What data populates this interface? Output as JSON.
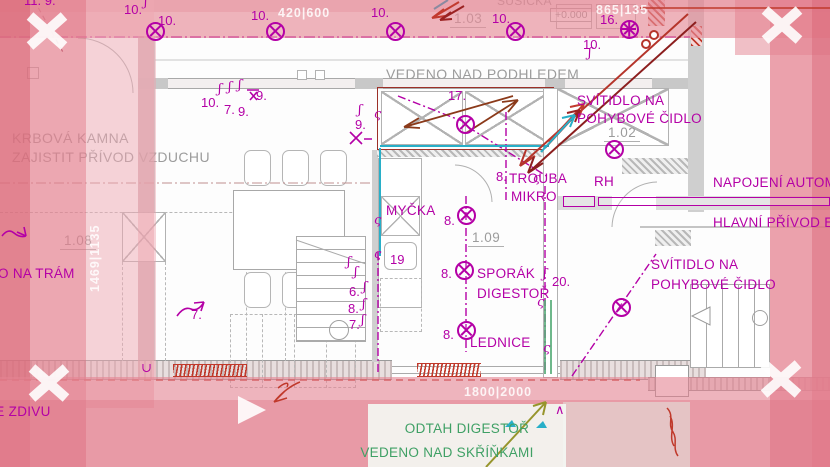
{
  "colors": {
    "magenta": "#b400a6",
    "gray_text": "#9c9c9c",
    "dark_red": "#9c3028",
    "red": "#c0392b",
    "cyan": "#28afc8",
    "green": "#3fa065",
    "olive": "#97952c",
    "pink_overlay": "#e48a9b"
  },
  "plan_texts": [
    {
      "t": "KRBOVÁ KAMNA",
      "x": 12,
      "y": 130,
      "c": "gtxt",
      "n": "note-fireplace-line1"
    },
    {
      "t": "ZAJISTIT PŘÍVOD VZDUCHU",
      "x": 12,
      "y": 149,
      "c": "gtxt",
      "n": "note-fireplace-line2"
    },
    {
      "t": "VEDENO NAD PODHLEDEM",
      "x": 386,
      "y": 66,
      "c": "gtxt",
      "n": "note-above-ceiling"
    },
    {
      "t": "SUŠIČKA",
      "x": 497,
      "y": -6,
      "c": "gtxtsm",
      "n": "label-dryer"
    },
    {
      "t": "1.08",
      "x": 60,
      "y": 233,
      "c": "room",
      "n": "room-label-108"
    },
    {
      "t": "1.09",
      "x": 468,
      "y": 230,
      "c": "room",
      "n": "room-label-109"
    },
    {
      "t": "1.03",
      "x": 450,
      "y": 11,
      "c": "room",
      "n": "room-label-103"
    },
    {
      "t": "1.02",
      "x": 604,
      "y": 125,
      "c": "room",
      "n": "room-label-102"
    },
    {
      "t": "+0.000",
      "x": 550,
      "y": 8,
      "c": "elev",
      "n": "elevation-marker"
    }
  ],
  "marker_texts": [
    {
      "t": "10.",
      "x": 124,
      "y": 2,
      "c": "num",
      "n": "circuit-number"
    },
    {
      "t": "10.",
      "x": 158,
      "y": 13,
      "c": "num",
      "n": "circuit-number"
    },
    {
      "t": "10.",
      "x": 251,
      "y": 8,
      "c": "num",
      "n": "circuit-number"
    },
    {
      "t": "10.",
      "x": 371,
      "y": 5,
      "c": "num",
      "n": "circuit-number"
    },
    {
      "t": "10.",
      "x": 492,
      "y": 11,
      "c": "num",
      "n": "circuit-number"
    },
    {
      "t": "16.",
      "x": 600,
      "y": 12,
      "c": "num",
      "n": "circuit-number"
    },
    {
      "t": "10.",
      "x": 583,
      "y": 37,
      "c": "num",
      "n": "circuit-number"
    },
    {
      "t": "10.",
      "x": 201,
      "y": 95,
      "c": "num",
      "n": "circuit-number"
    },
    {
      "t": "7.",
      "x": 224,
      "y": 102,
      "c": "num",
      "n": "circuit-number"
    },
    {
      "t": "9.",
      "x": 238,
      "y": 104,
      "c": "num",
      "n": "circuit-number"
    },
    {
      "t": "9.",
      "x": 256,
      "y": 88,
      "c": "num",
      "n": "circuit-number"
    },
    {
      "t": "9.",
      "x": 355,
      "y": 117,
      "c": "num",
      "n": "circuit-number"
    },
    {
      "t": "17.",
      "x": 448,
      "y": 88,
      "c": "num",
      "n": "circuit-number"
    },
    {
      "t": "8.",
      "x": 496,
      "y": 169,
      "c": "num",
      "n": "circuit-number"
    },
    {
      "t": "8.",
      "x": 444,
      "y": 213,
      "c": "num",
      "n": "circuit-number"
    },
    {
      "t": "8.",
      "x": 441,
      "y": 266,
      "c": "num",
      "n": "circuit-number"
    },
    {
      "t": "8.",
      "x": 443,
      "y": 327,
      "c": "num",
      "n": "circuit-number"
    },
    {
      "t": "20.",
      "x": 552,
      "y": 274,
      "c": "num",
      "n": "circuit-number"
    },
    {
      "t": "19",
      "x": 390,
      "y": 252,
      "c": "num",
      "n": "circuit-number"
    },
    {
      "t": "6.",
      "x": 349,
      "y": 284,
      "c": "num",
      "n": "circuit-number"
    },
    {
      "t": "8.",
      "x": 348,
      "y": 301,
      "c": "num",
      "n": "circuit-number"
    },
    {
      "t": "7.",
      "x": 349,
      "y": 317,
      "c": "num",
      "n": "circuit-number"
    },
    {
      "t": "7.",
      "x": 191,
      "y": 307,
      "c": "num",
      "n": "circuit-number"
    },
    {
      "t": "11. 9.",
      "x": 24,
      "y": -7,
      "c": "num",
      "n": "circuit-number"
    },
    {
      "t": "∧",
      "x": 555,
      "y": 402,
      "c": "num",
      "n": "mark-caret"
    },
    {
      "t": "MYČKA",
      "x": 386,
      "y": 203,
      "c": "lbl",
      "n": "label-dishwasher"
    },
    {
      "t": "TROUBA",
      "x": 509,
      "y": 171,
      "c": "lbl",
      "n": "label-oven"
    },
    {
      "t": "MIKRO",
      "x": 511,
      "y": 189,
      "c": "lbl",
      "n": "label-microwave"
    },
    {
      "t": "SPORÁK",
      "x": 477,
      "y": 266,
      "c": "lbl",
      "n": "label-stove"
    },
    {
      "t": "DIGESTOŘ",
      "x": 477,
      "y": 286,
      "c": "lbl",
      "n": "label-hood"
    },
    {
      "t": "LEDNICE",
      "x": 470,
      "y": 335,
      "c": "lbl",
      "n": "label-fridge"
    },
    {
      "t": "SVÍTIDLO NA",
      "x": 577,
      "y": 93,
      "c": "lbl",
      "n": "label-motion-light-1"
    },
    {
      "t": "POHYBOVÉ ČIDLO",
      "x": 577,
      "y": 111,
      "c": "lbl",
      "n": "label-motion-light-1b"
    },
    {
      "t": "SVÍTIDLO NA",
      "x": 651,
      "y": 257,
      "c": "lbl",
      "n": "label-motion-light-2"
    },
    {
      "t": "POHYBOVÉ ČIDLO",
      "x": 651,
      "y": 277,
      "c": "lbl",
      "n": "label-motion-light-2b"
    },
    {
      "t": "NAPOJENÍ AUTOMATI",
      "x": 713,
      "y": 175,
      "c": "lbl",
      "n": "label-automation-feed"
    },
    {
      "t": "HLAVNÍ PŘÍVOD ELEK",
      "x": 713,
      "y": 215,
      "c": "lbl",
      "n": "label-main-supply"
    },
    {
      "t": "RH",
      "x": 594,
      "y": 174,
      "c": "lbl",
      "n": "label-switchboard"
    },
    {
      "t": "VEDENO NA TRÁM",
      "x": -50,
      "y": 266,
      "c": "lbl",
      "n": "label-on-beam"
    },
    {
      "t": "VE ZDIVU",
      "x": -14,
      "y": 404,
      "c": "lbl",
      "n": "label-in-masonry"
    }
  ],
  "dimensions": [
    {
      "t": "420|600",
      "x": 278,
      "y": 6,
      "v": false
    },
    {
      "t": "865|135",
      "x": 596,
      "y": 3,
      "v": false
    },
    {
      "t": "1800|2000",
      "x": 464,
      "y": 385,
      "v": false
    },
    {
      "t": "1469|1135",
      "x": 88,
      "y": 292,
      "v": true
    }
  ],
  "note": {
    "line1": "ODTAH DIGESTOŘ",
    "line2": "VEDENO NAD SKŘÍŇKAMI"
  },
  "lights": [
    {
      "x": 155,
      "y": 31,
      "k": "x"
    },
    {
      "x": 275,
      "y": 31,
      "k": "x"
    },
    {
      "x": 395,
      "y": 31,
      "k": "x"
    },
    {
      "x": 515,
      "y": 31,
      "k": "x"
    },
    {
      "x": 629,
      "y": 29,
      "k": "s"
    },
    {
      "x": 465,
      "y": 124,
      "k": "x"
    },
    {
      "x": 614,
      "y": 149,
      "k": "x"
    },
    {
      "x": 466,
      "y": 215,
      "k": "x"
    },
    {
      "x": 464,
      "y": 270,
      "k": "x"
    },
    {
      "x": 466,
      "y": 330,
      "k": "x"
    },
    {
      "x": 621,
      "y": 307,
      "k": "x"
    }
  ],
  "squiggles": [
    {
      "x": 144,
      "y": -4,
      "g": "ʃ"
    },
    {
      "x": 218,
      "y": 83,
      "g": "ʃ"
    },
    {
      "x": 228,
      "y": 81,
      "g": "ʃ"
    },
    {
      "x": 238,
      "y": 79,
      "g": "ʃ"
    },
    {
      "x": 358,
      "y": 104,
      "g": "ʃ"
    },
    {
      "x": 588,
      "y": 47,
      "g": "ʃ"
    },
    {
      "x": 363,
      "y": 281,
      "g": "ʃ"
    },
    {
      "x": 362,
      "y": 298,
      "g": "ʃ"
    },
    {
      "x": 361,
      "y": 314,
      "g": "ʃ"
    },
    {
      "x": 347,
      "y": 256,
      "g": "ʃ"
    },
    {
      "x": 354,
      "y": 266,
      "g": "ʃ"
    },
    {
      "x": 543,
      "y": 268,
      "g": "ʃ"
    },
    {
      "x": 374,
      "y": 108,
      "g": "ς"
    },
    {
      "x": 374,
      "y": 214,
      "g": "ς"
    },
    {
      "x": 374,
      "y": 248,
      "g": "ς"
    },
    {
      "x": 533,
      "y": 172,
      "g": "ς"
    },
    {
      "x": 537,
      "y": 296,
      "g": "ς"
    },
    {
      "x": 543,
      "y": 342,
      "g": "ς"
    },
    {
      "x": 141,
      "y": 362,
      "g": "∪"
    }
  ]
}
